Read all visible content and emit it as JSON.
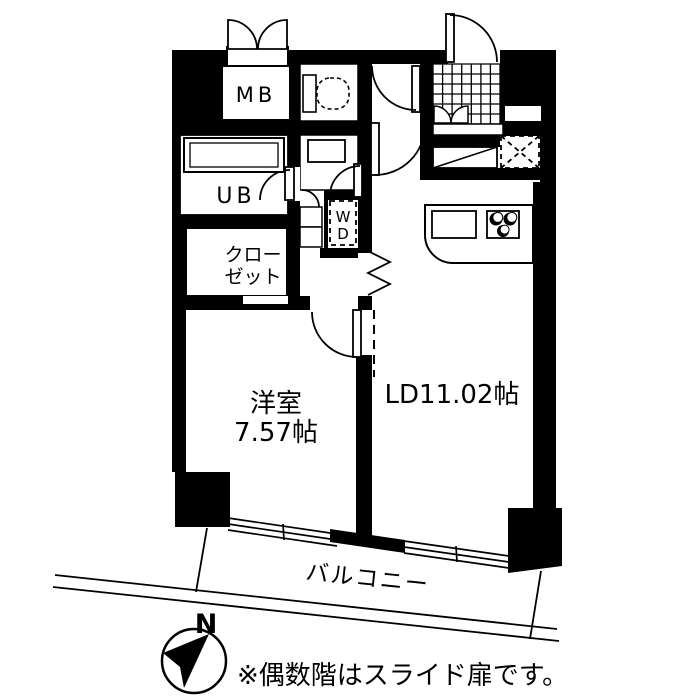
{
  "labels": {
    "mb": "MB",
    "ub": "UB",
    "closet_1": "クロー",
    "closet_2": "ゼット",
    "wd_1": "W",
    "wd_2": "D",
    "western_room_1": "洋室",
    "western_room_2": "7.57帖",
    "living_dining": "LD11.02帖",
    "balcony": "バルコニー",
    "north": "N",
    "note": "※偶数階はスライド扉です。"
  },
  "colors": {
    "wall": "#000000",
    "background": "#ffffff"
  }
}
